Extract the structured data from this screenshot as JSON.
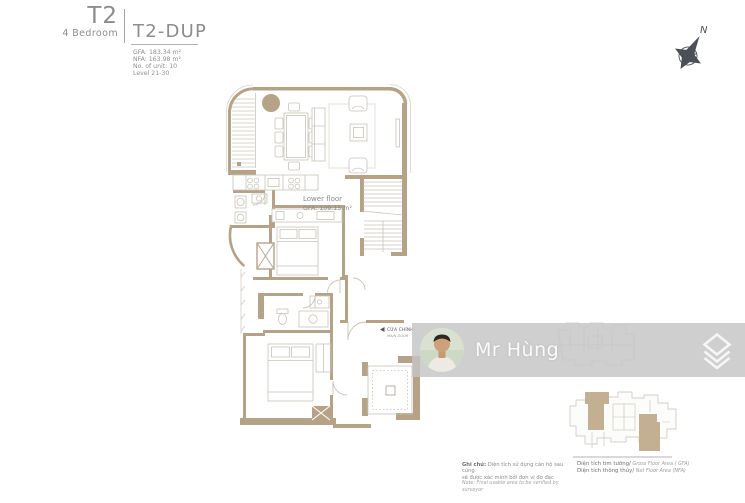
{
  "header": {
    "unit_type": "T2",
    "unit_subtitle": "4 Bedroom",
    "unit_code": "T2-DUP",
    "stats": [
      "GFA: 183.34 m²",
      "NFA: 163.98 m²",
      "No. of unit: 10",
      "Level 21-30"
    ]
  },
  "compass": {
    "north_label": "N"
  },
  "plan": {
    "floor_label": "Lower floor",
    "floor_area_label": "GFA: 109.15 m²",
    "main_door_label": "CỬA CHÍNH",
    "main_door_sublabel": "MAIN DOOR"
  },
  "watermark": {
    "agent_name": "Mr Hùng",
    "logo_icon": "brand-diamond-icon"
  },
  "legend": {
    "note_prefix": "Ghi chú:",
    "note_line1": " Diện tích sử dụng căn hộ sau cùng",
    "note_line2": "sẽ được xác minh bởi đơn vị đo đạc",
    "note_en": "Note: Final usable area to be verified by surveyor",
    "gfa_vi": "Diện tích tim tường/",
    "gfa_en": " Gross Floor Area ( GFA)",
    "nfa_vi": "Diện tích thông thủy/",
    "nfa_en": " Net Floor Area (NFA)"
  },
  "colors": {
    "wall": "#b6a287",
    "furniture_line": "#ccc7ba",
    "text_gray": "#8d8d8d",
    "watermark_bar": "#c4c4c4",
    "keyplan_highlight": "#c3b092",
    "compass": "#4b5058"
  }
}
